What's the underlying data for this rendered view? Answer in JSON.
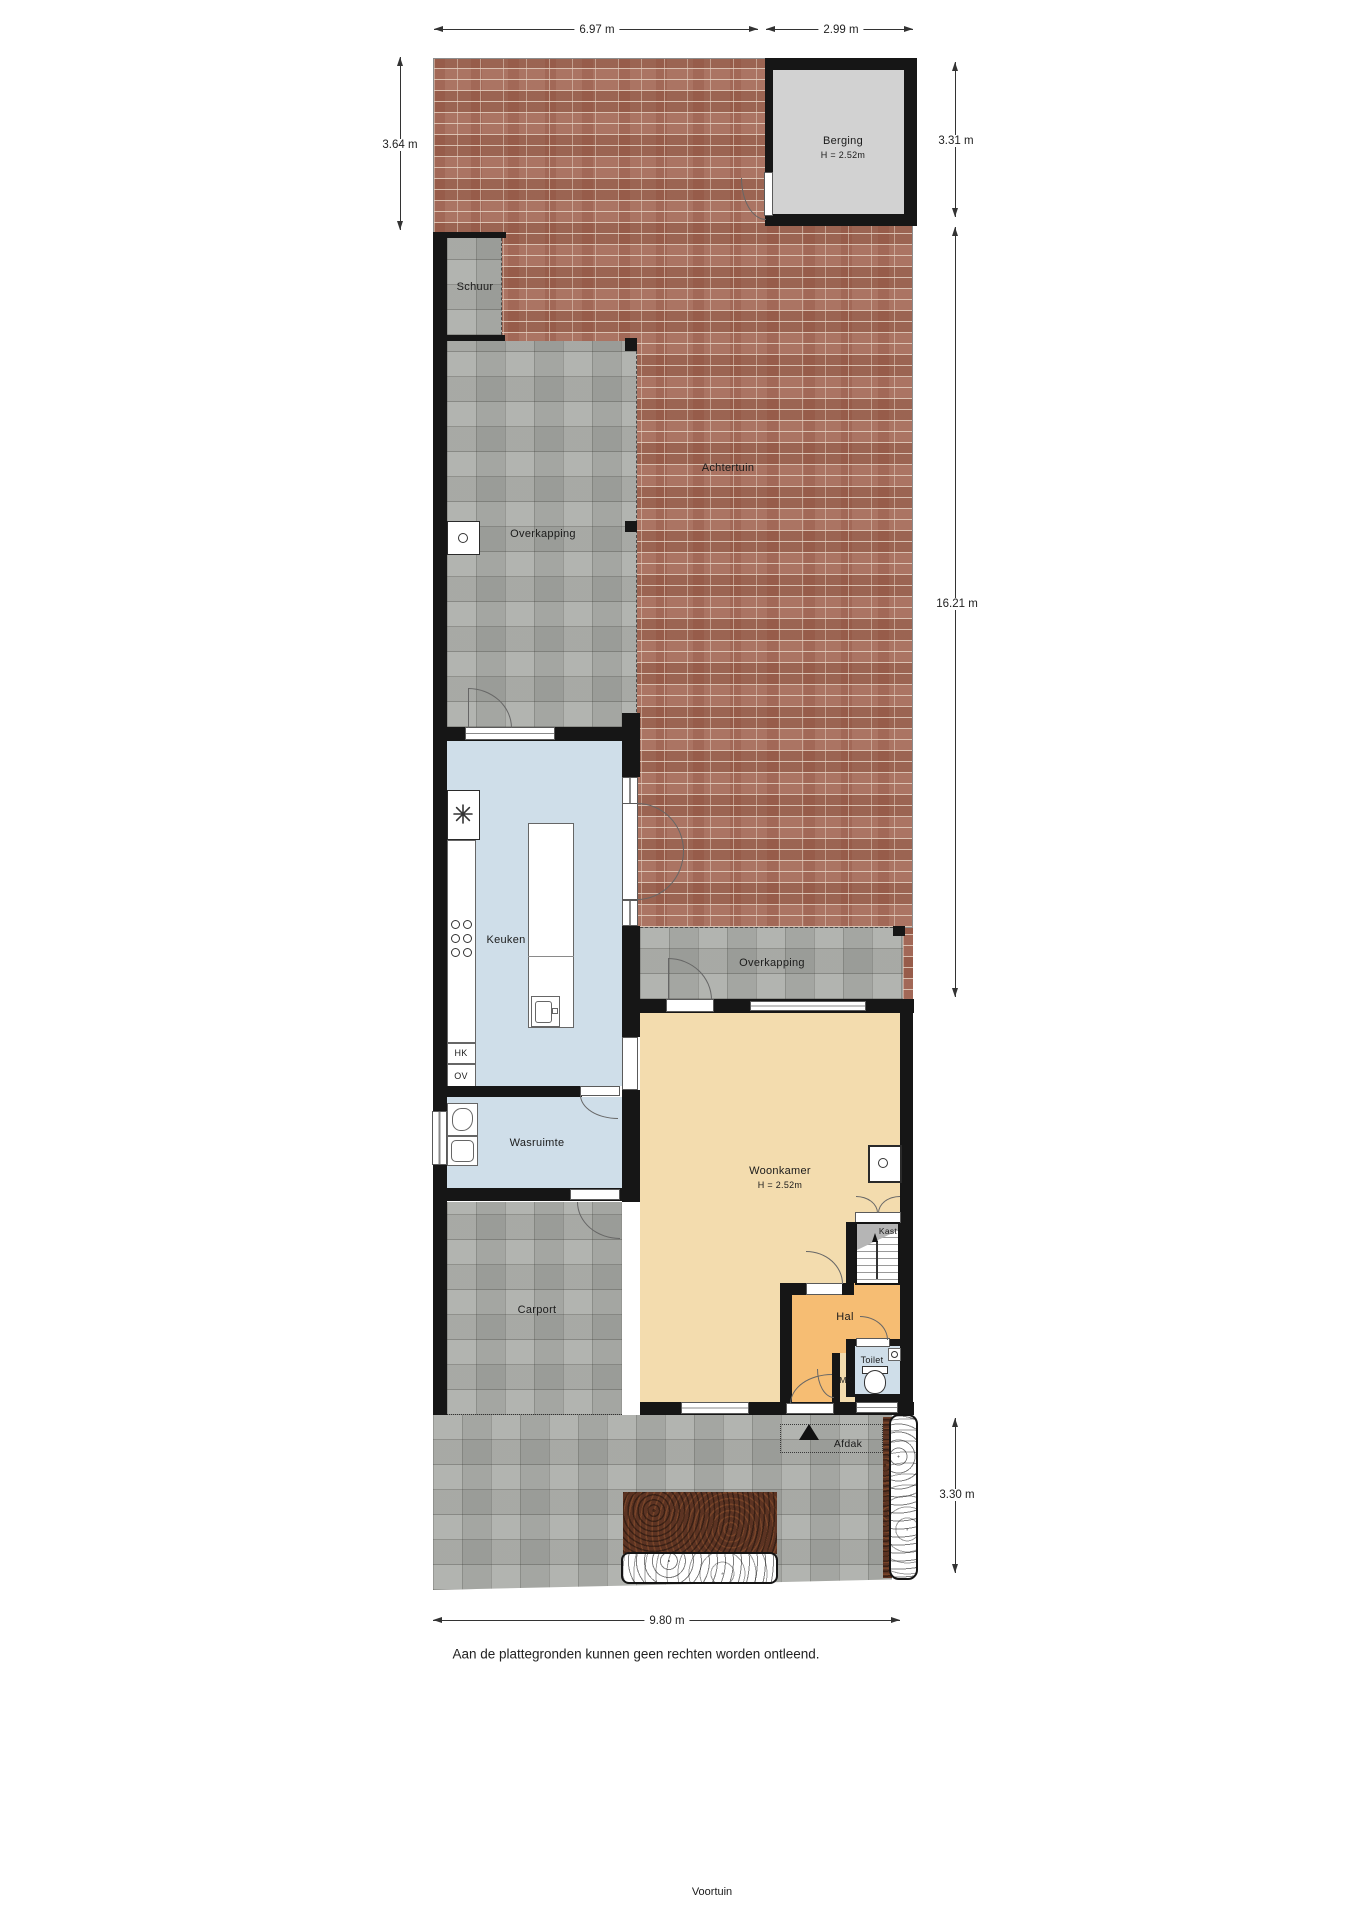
{
  "colors": {
    "wall": "#161616",
    "brick_garden": "#a56a57",
    "concrete_tiles": "#a9aba6",
    "kitchen_floor": "#cfdee9",
    "living_floor": "#f3dcae",
    "hall_floor": "#f6bd73",
    "berging_floor": "#d2d2d2",
    "soil": "#5c3322"
  },
  "rooms": {
    "berging": {
      "label": "Berging",
      "height": "H = 2.52m"
    },
    "schuur": {
      "label": "Schuur"
    },
    "achtertuin": {
      "label": "Achtertuin"
    },
    "overkapping_boven": {
      "label": "Overkapping"
    },
    "overkapping_onder": {
      "label": "Overkapping"
    },
    "keuken": {
      "label": "Keuken"
    },
    "wasruimte": {
      "label": "Wasruimte"
    },
    "woonkamer": {
      "label": "Woonkamer",
      "height": "H = 2.52m"
    },
    "carport": {
      "label": "Carport"
    },
    "hal": {
      "label": "Hal"
    },
    "kast": {
      "label": "Kast"
    },
    "toilet": {
      "label": "Toilet"
    },
    "meterkast": {
      "label": "MK"
    },
    "afdak": {
      "label": "Afdak"
    },
    "voortuin": {
      "label": "Voortuin"
    }
  },
  "fixtures": {
    "hk": "HK",
    "ov": "OV"
  },
  "dimensions": {
    "achtertuin_breedte": "6.97 m",
    "berging_breedte": "2.99 m",
    "achtertuin_diepte": "3.64 m",
    "berging_diepte": "3.31 m",
    "perceel_diepte": "16.21 m",
    "voortuin_diepte": "3.30 m",
    "perceel_breedte": "9.80 m"
  },
  "footer": {
    "disclaimer": "Aan de plattegronden kunnen geen rechten worden ontleend."
  }
}
